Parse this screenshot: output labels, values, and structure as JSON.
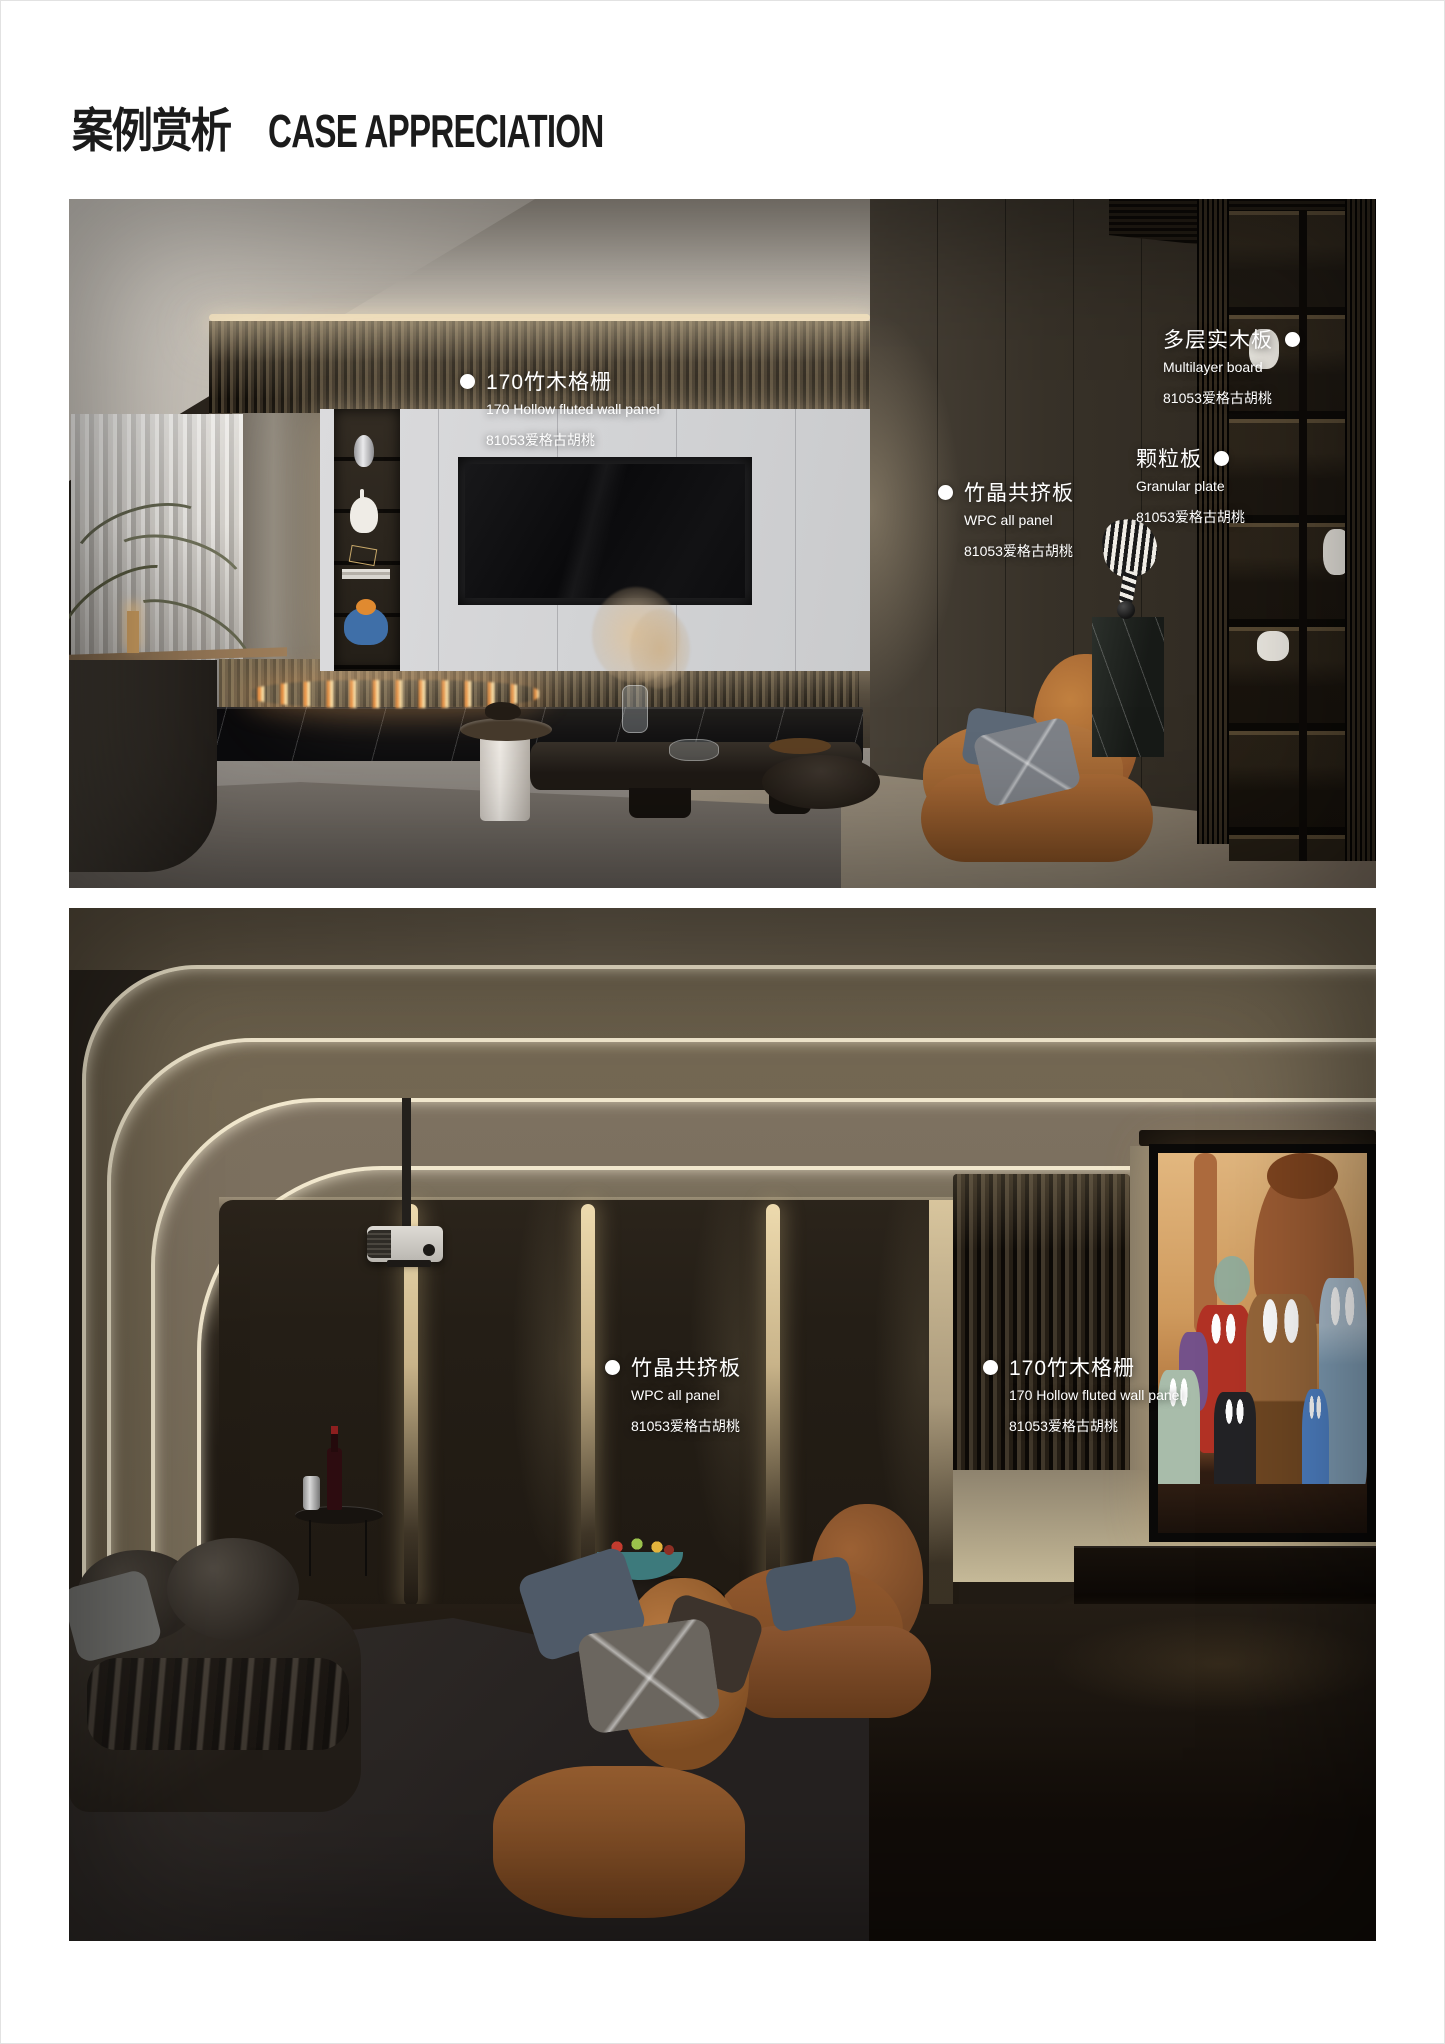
{
  "page": {
    "title_zh": "案例赏析",
    "title_en": "CASE APPRECIATION"
  },
  "colors": {
    "title_text": "#1b1b1b",
    "label_text": "#ffffff",
    "accent_warm_light": "#f1e7cd"
  },
  "callouts": {
    "p1_fluted": {
      "label": "170竹木格栅",
      "sub": "170 Hollow fluted wall panel",
      "code": "81053爱格古胡桃"
    },
    "p1_wpc": {
      "label": "竹晶共挤板",
      "sub": "WPC all panel",
      "code": "81053爱格古胡桃"
    },
    "p1_multilayer": {
      "label": "多层实木板",
      "sub": "Multilayer board",
      "code": "81053爱格古胡桃"
    },
    "p1_granular": {
      "label": "颗粒板",
      "sub": "Granular plate",
      "code": "81053爱格古胡桃"
    },
    "p2_wpc": {
      "label": "竹晶共挤板",
      "sub": "WPC all panel",
      "code": "81053爱格古胡桃"
    },
    "p2_fluted": {
      "label": "170竹木格栅",
      "sub": "170 Hollow fluted wall panel",
      "code": "81053爱格古胡桃"
    }
  },
  "photos": {
    "photo1": {
      "scene": "modern living room with backlit white TV wall, ethanol fireplace, caramel lounge chair and dark wood shelving"
    },
    "photo2": {
      "scene": "home theater with curved ceiling light lines, projector, dark wall panels and projection screen",
      "screen_content": "animated cars movie scene"
    }
  }
}
